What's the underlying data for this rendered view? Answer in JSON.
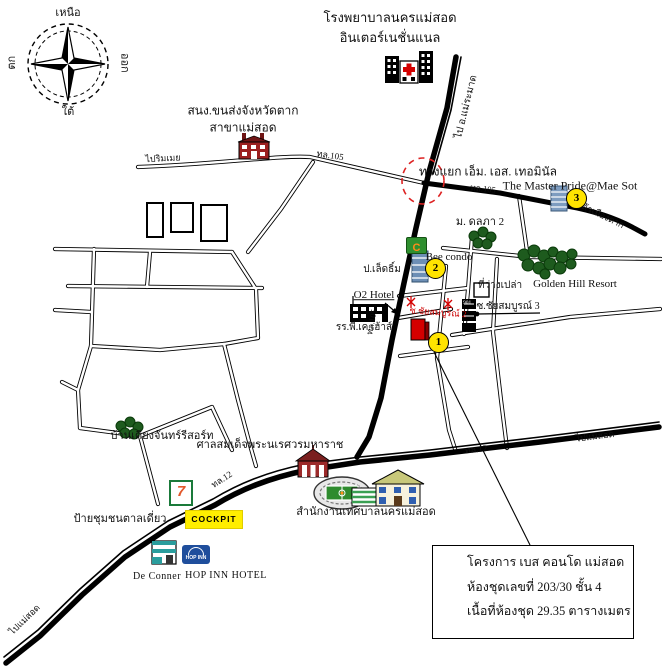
{
  "compass": {
    "north": "เหนือ",
    "south": "ใต้",
    "east": "ออก",
    "west": "ตก"
  },
  "labels": {
    "hospital_line1": "โรงพยาบาลนครแม่สอด",
    "hospital_line2": "อินเตอร์เนชั่นแนล",
    "road_mae_ramat": "ไป อ.แม่ระมาด",
    "transport_office_line1": "สนง.ขนส่งจังหวัดตาก",
    "transport_office_line2": "สาขาแม่สอด",
    "road_rim_moei": "ไปริมเมย",
    "road_105": "ทล.105",
    "junction": "ทางแยก เอ็ม. เอส. เทอมินัล",
    "master_pride": "The Master Pride@Mae Sot",
    "road_to_tak": "ไปตัวเมืองตาก",
    "village_dolapa": "ม. ดลภา 2",
    "bee_condo": "Bee condo",
    "p_led": "ป.เล็ดธิ์ม",
    "golden_hill": "Golden Hill Resort",
    "empty_land": "ที่ว่างเปล่า",
    "soi_chai_3": "ซ.ชัยสมบูรณ์ 3",
    "house_901": "901",
    "o2_hotel": "O2 Hotel",
    "pk_house": "รร.พี.เค.เฮ้าส์",
    "soi_chai_2": "ซ.ชัยสมบูรณ์ 2",
    "shrine": "ศาลสมเด็จพระนเรศวรมหาราช",
    "baan_kiang_chan": "บ้านเคียงจันทร์รีสอร์ท",
    "road_12": "ทล.12",
    "cockpit": "COCKPIT",
    "community_sign": "ป้ายชุมชนตาลเดี่ยว",
    "municipality": "สำนักงานเทศบาลนครแม่สอด",
    "de_conner": "De Conner",
    "hop_inn_hotel": "HOP INN HOTEL",
    "hop_inn_logo": "HOP INN",
    "seven_eleven": "7",
    "c_logo": "C",
    "road_mae_sot": "ไปแม่สอด",
    "road_mae_sot_sw": "ไปแม่สอด"
  },
  "badges": {
    "b1": "1",
    "b2": "2",
    "b3": "3"
  },
  "legend": {
    "line1": "โครงการ เบส คอนโด แม่สอด",
    "line2": "ห้องชุดเลขที่ 203/30 ชั้น 4",
    "line3": "เนื้อที่ห้องชุด 29.35 ตารางเมตร"
  },
  "colors": {
    "road": "#000000",
    "badge_yellow": "#ffe400",
    "subject_red": "#cc0000",
    "tree_green": "#1e5b1e",
    "cockpit_yellow": "#ffee00",
    "dashed_circle_red": "#dd2222"
  }
}
